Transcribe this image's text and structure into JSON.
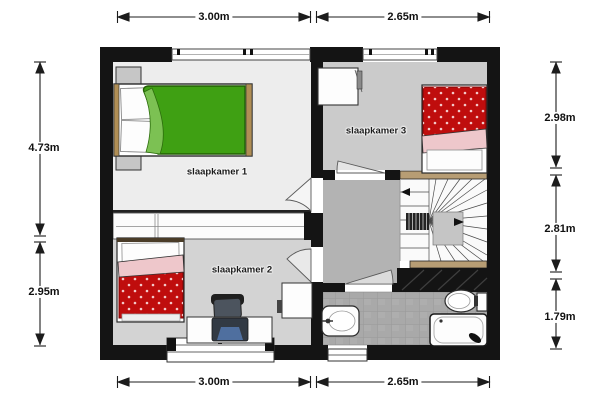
{
  "title": "floor-plan-upper-storey",
  "rooms": {
    "room1": {
      "label": "slaapkamer 1",
      "width": "3.00m",
      "height": "4.73m"
    },
    "room2": {
      "label": "slaapkamer 2",
      "width": "3.00m",
      "height": "2.95m"
    },
    "room3": {
      "label": "slaapkamer 3",
      "width": "2.65m",
      "height": "2.98m"
    },
    "hall_stairs": {
      "height": "2.81m"
    },
    "bathroom": {
      "height": "1.79m"
    }
  },
  "dimensions": {
    "top_left": "3.00m",
    "top_right": "2.65m",
    "bottom_left": "3.00m",
    "bottom_right": "2.65m",
    "left_upper": "4.73m",
    "left_lower": "2.95m",
    "right_upper": "2.98m",
    "right_middle": "2.81m",
    "right_lower": "1.79m"
  },
  "furniture_icons": [
    "double-bed-icon",
    "nightstand-icon",
    "nightstand-icon",
    "wardrobe-band-icon",
    "single-bed-icon",
    "desk-icon",
    "office-chair-icon",
    "laptop-icon",
    "cabinet-icon",
    "wardrobe-icon",
    "single-bed-icon",
    "winder-stairs-icon",
    "sink-icon",
    "toilet-icon",
    "bathtub-icon",
    "door-swing-icon",
    "window-icon"
  ],
  "colors": {
    "wall": "#141414",
    "floor_room1": "#ededed",
    "floor_room2": "#d3d3d3",
    "floor_room3": "#cbcbcb",
    "floor_hall": "#b3b3b3",
    "floor_bathroom": "#a9a9a9",
    "bed_green": "#3fa013",
    "bed_green_fold": "#7cc153",
    "bed_red": "#bf0d0d",
    "bed_pink": "#eec7cb",
    "stair_wood": "#b79d74",
    "laptop_blue": "#4f6f9f"
  }
}
